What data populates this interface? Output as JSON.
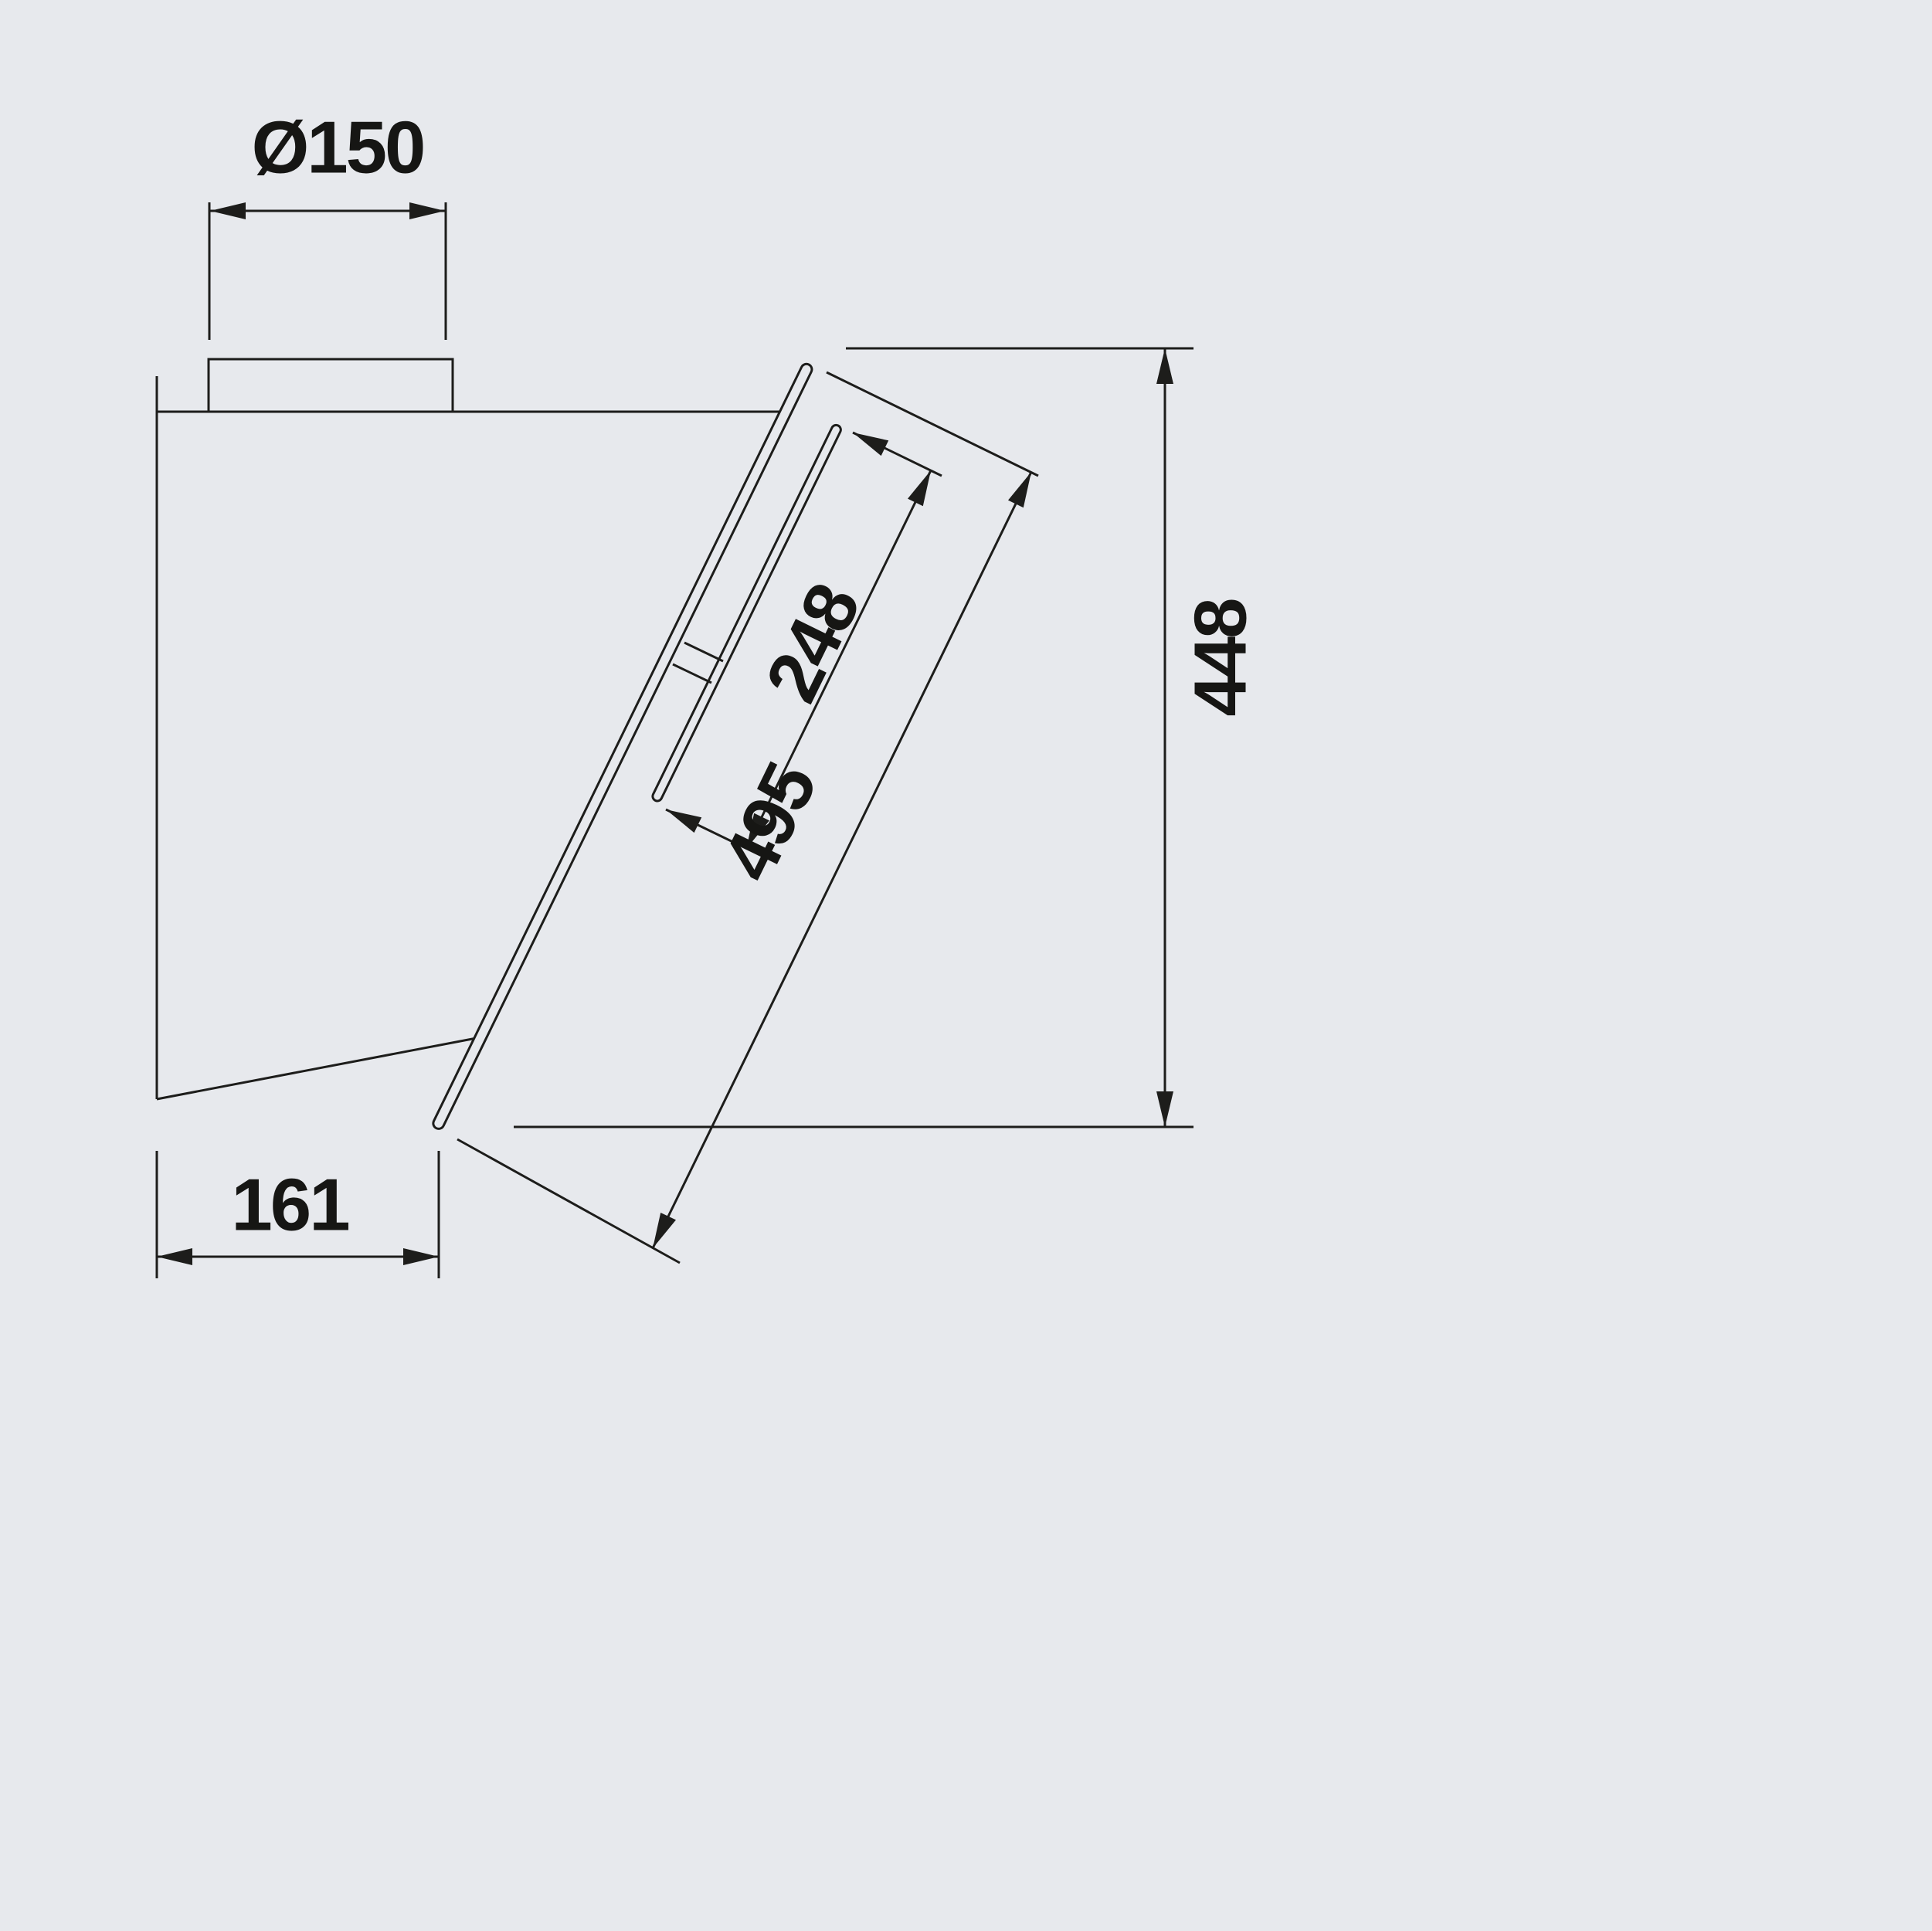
{
  "drawing": {
    "kind": "technical-dimension-drawing",
    "subject": "wall-mounted-cooker-hood-side-view",
    "colors": {
      "background": "#e7e9ed",
      "line": "#1d1d1b",
      "text": "#161614"
    },
    "dimensions": {
      "duct_diameter": {
        "label": "Ø150",
        "value": 150
      },
      "inner_panel_length": {
        "label": "248",
        "value": 248
      },
      "front_panel_length": {
        "label": "495",
        "value": 495
      },
      "overall_height": {
        "label": "448",
        "value": 448
      },
      "body_depth": {
        "label": "161",
        "value": 161
      }
    }
  }
}
